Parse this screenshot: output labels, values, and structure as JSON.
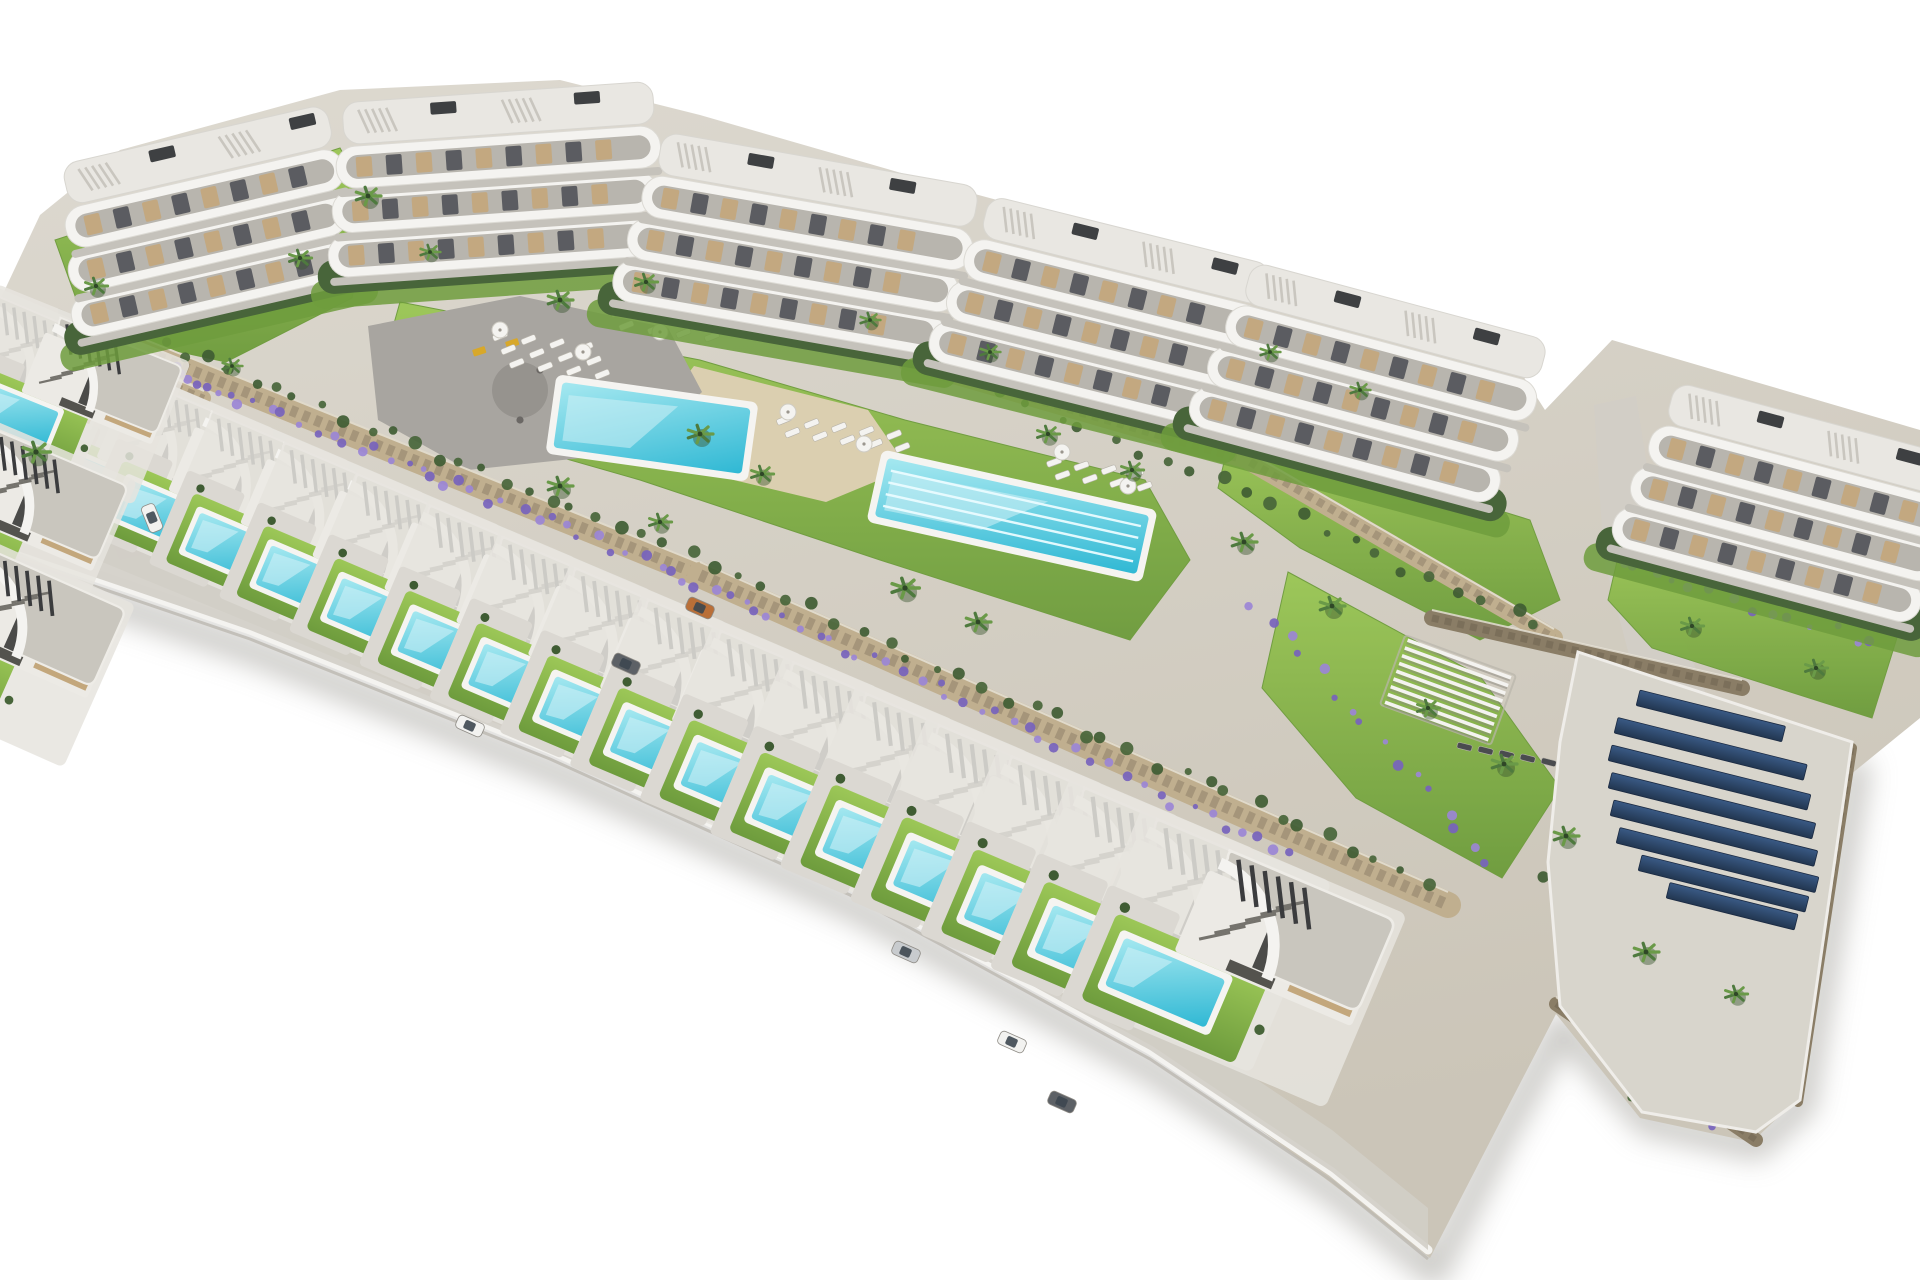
{
  "scene": {
    "description": "Aerial 3D architectural render of a hillside residential development on a white background: a curved row of six white apartment blocks with wavy terraces at the top, communal gardens with a main swimming pool, a lap pool, sun loungers, a playground plaza and palm trees in the middle, a long diagonal row of modern villas each with a private turquoise pool in front, and a rooftop solar-panel array at the lower right."
  },
  "palette": {
    "bg": "#ffffff",
    "terrain_light": "#ddd9d0",
    "terrain_dark": "#cbc5b8",
    "road": "#d2cec6",
    "drive": "#dbd8d2",
    "plot": "#e6e4de",
    "white1": "#f4f3f0",
    "white2": "#eceae5",
    "roof": "#c9c6be",
    "roof_edge": "#eeece7",
    "slat": "#3b3c3e",
    "stair": "#75736d",
    "beige": "#c3a77c",
    "win": "#4b4b49",
    "door": "#54534e",
    "lawn_light": "#9cc757",
    "lawn_dark": "#6e9c3d",
    "hedge": "#48653a",
    "scrub": "#3f5c33",
    "palm1": "#4e7a3e",
    "palm2": "#6a9a48",
    "lavender1": "#9b85d6",
    "lavender2": "#7763bd",
    "pool_rim": "#f5f4f1",
    "pool_light": "#a5e8f0",
    "pool_dark": "#2fb8d4",
    "sand": "#dbcfb0",
    "plaza": "#a8a5a0",
    "plaza_dark": "#96938e",
    "wall_tan": "#c0af8f",
    "wall_joint": "#8f8069",
    "wall_dark": "#8a7d66",
    "wall_dark2": "#6f6452",
    "deck": "#d8d5cc",
    "solar_light": "#3a5a85",
    "solar_dark": "#223650",
    "shadow": "#c6c5c1",
    "terrace": "#b8b5ae",
    "furn": "#53555a",
    "car_white": "#f2f2f0",
    "car_orange": "#b96f38",
    "car_gray": "#5d6166",
    "car_silver": "#c8cbce",
    "play_yellow": "#d8a82a"
  },
  "site": {
    "outline": [
      [
        40,
        215
      ],
      [
        120,
        150
      ],
      [
        340,
        90
      ],
      [
        560,
        80
      ],
      [
        700,
        115
      ],
      [
        960,
        190
      ],
      [
        1250,
        268
      ],
      [
        1500,
        340
      ],
      [
        1545,
        410
      ],
      [
        1612,
        340
      ],
      [
        1920,
        430
      ],
      [
        1920,
        718
      ],
      [
        1850,
        775
      ],
      [
        1788,
        1108
      ],
      [
        1752,
        1142
      ],
      [
        1640,
        1118
      ],
      [
        1556,
        1014
      ],
      [
        1497,
        1128
      ],
      [
        1430,
        1258
      ],
      [
        1150,
        1046
      ],
      [
        848,
        880
      ],
      [
        548,
        745
      ],
      [
        248,
        622
      ],
      [
        0,
        520
      ],
      [
        0,
        300
      ]
    ],
    "curb": [
      [
        0,
        545
      ],
      [
        250,
        630
      ],
      [
        550,
        750
      ],
      [
        850,
        886
      ],
      [
        1150,
        1050
      ],
      [
        1332,
        1172
      ],
      [
        1428,
        1250
      ]
    ],
    "shadow_extra": [
      [
        1500,
        1138
      ],
      [
        1562,
        1026
      ],
      [
        1648,
        1122
      ],
      [
        1756,
        1146
      ],
      [
        1802,
        1104
      ],
      [
        1856,
        772
      ]
    ],
    "roads": [
      [
        [
          1594,
          405
        ],
        [
          1636,
          396
        ],
        [
          1668,
          600
        ],
        [
          1706,
          694
        ],
        [
          1644,
          712
        ],
        [
          1604,
          560
        ]
      ],
      [
        [
          58,
          308
        ],
        [
          108,
          330
        ],
        [
          170,
          548
        ],
        [
          120,
          560
        ],
        [
          60,
          430
        ]
      ]
    ]
  },
  "lawns": [
    [
      [
        55,
        240
      ],
      [
        340,
        148
      ],
      [
        372,
        205
      ],
      [
        352,
        298
      ],
      [
        226,
        362
      ],
      [
        88,
        332
      ]
    ],
    [
      [
        400,
        302
      ],
      [
        700,
        360
      ],
      [
        905,
        420
      ],
      [
        1145,
        480
      ],
      [
        1190,
        560
      ],
      [
        1130,
        640
      ],
      [
        880,
        560
      ],
      [
        640,
        480
      ],
      [
        430,
        420
      ],
      [
        386,
        352
      ]
    ],
    [
      [
        1288,
        572
      ],
      [
        1480,
        676
      ],
      [
        1560,
        788
      ],
      [
        1502,
        878
      ],
      [
        1356,
        798
      ],
      [
        1262,
        688
      ]
    ],
    [
      [
        1622,
        540
      ],
      [
        1900,
        628
      ],
      [
        1872,
        718
      ],
      [
        1652,
        648
      ],
      [
        1608,
        600
      ]
    ],
    [
      [
        1232,
        428
      ],
      [
        1530,
        520
      ],
      [
        1560,
        600
      ],
      [
        1480,
        640
      ],
      [
        1300,
        548
      ],
      [
        1218,
        488
      ]
    ]
  ],
  "sand": [
    [
      694,
      366
    ],
    [
      868,
      410
    ],
    [
      908,
      468
    ],
    [
      826,
      502
    ],
    [
      700,
      472
    ],
    [
      652,
      420
    ]
  ],
  "playground": {
    "outline": [
      [
        368,
        326
      ],
      [
        520,
        296
      ],
      [
        668,
        328
      ],
      [
        702,
        392
      ],
      [
        638,
        452
      ],
      [
        468,
        470
      ],
      [
        378,
        420
      ]
    ],
    "inner": {
      "cx": 520,
      "cy": 390,
      "r": 28
    },
    "equipment": [
      [
        472,
        350
      ],
      [
        505,
        342
      ]
    ],
    "dots": [
      [
        540,
        370
      ],
      [
        575,
        385
      ],
      [
        520,
        420
      ],
      [
        620,
        398
      ]
    ]
  },
  "walls": [
    {
      "x1": 146,
      "y1": 352,
      "x2": 700,
      "y2": 575,
      "w": 24,
      "tone": "tan"
    },
    {
      "x1": 700,
      "y1": 575,
      "x2": 1448,
      "y2": 905,
      "w": 26,
      "tone": "tan"
    },
    {
      "x1": 44,
      "y1": 330,
      "x2": 204,
      "y2": 398,
      "w": 14,
      "tone": "tan"
    },
    {
      "x1": 905,
      "y1": 362,
      "x2": 1250,
      "y2": 462,
      "w": 16,
      "tone": "tan"
    },
    {
      "x1": 1250,
      "y1": 462,
      "x2": 1554,
      "y2": 638,
      "w": 18,
      "tone": "tan"
    },
    {
      "x1": 1432,
      "y1": 618,
      "x2": 1742,
      "y2": 688,
      "w": 16,
      "tone": "dark"
    },
    {
      "x1": 1556,
      "y1": 1004,
      "x2": 1756,
      "y2": 1140,
      "w": 14,
      "tone": "dark"
    },
    {
      "x1": 1852,
      "y1": 748,
      "x2": 1798,
      "y2": 1102,
      "w": 10,
      "tone": "dark"
    }
  ],
  "planting": {
    "lavender": [
      {
        "x1": 150,
        "y1": 360,
        "x2": 440,
        "y2": 478,
        "n": 20
      },
      {
        "x1": 440,
        "y1": 478,
        "x2": 708,
        "y2": 585,
        "n": 18
      },
      {
        "x1": 708,
        "y1": 585,
        "x2": 1000,
        "y2": 718,
        "n": 20
      },
      {
        "x1": 1000,
        "y1": 718,
        "x2": 1300,
        "y2": 860,
        "n": 18
      },
      {
        "x1": 1248,
        "y1": 600,
        "x2": 1500,
        "y2": 868,
        "n": 16
      },
      {
        "x1": 1608,
        "y1": 556,
        "x2": 1880,
        "y2": 648,
        "n": 14
      },
      {
        "x1": 1560,
        "y1": 1010,
        "x2": 1726,
        "y2": 1128,
        "n": 10
      },
      {
        "x1": 60,
        "y1": 318,
        "x2": 206,
        "y2": 390,
        "n": 10
      }
    ],
    "bushes": [
      {
        "x1": 150,
        "y1": 340,
        "x2": 700,
        "y2": 560,
        "n": 24
      },
      {
        "x1": 700,
        "y1": 560,
        "x2": 1440,
        "y2": 890,
        "n": 30
      },
      {
        "x1": 910,
        "y1": 350,
        "x2": 1554,
        "y2": 630,
        "n": 24
      },
      {
        "x1": 1545,
        "y1": 860,
        "x2": 1640,
        "y2": 1110,
        "n": 10
      }
    ],
    "palms": [
      [
        368,
        196,
        1.0
      ],
      [
        300,
        258,
        0.9
      ],
      [
        96,
        286,
        0.9
      ],
      [
        36,
        452,
        1.1
      ],
      [
        232,
        366,
        0.8
      ],
      [
        430,
        252,
        0.8
      ],
      [
        560,
        300,
        1.0
      ],
      [
        646,
        282,
        0.9
      ],
      [
        700,
        434,
        1.0
      ],
      [
        762,
        474,
        0.9
      ],
      [
        560,
        486,
        1.0
      ],
      [
        660,
        522,
        0.9
      ],
      [
        905,
        588,
        1.1
      ],
      [
        978,
        622,
        1.0
      ],
      [
        1048,
        434,
        0.9
      ],
      [
        1132,
        470,
        0.9
      ],
      [
        1244,
        542,
        1.0
      ],
      [
        1332,
        606,
        1.0
      ],
      [
        1428,
        708,
        0.9
      ],
      [
        1504,
        764,
        1.0
      ],
      [
        1566,
        836,
        1.0
      ],
      [
        1692,
        626,
        0.9
      ],
      [
        1816,
        668,
        0.9
      ],
      [
        1646,
        952,
        1.0
      ],
      [
        1736,
        994,
        0.9
      ],
      [
        1270,
        352,
        0.8
      ],
      [
        1360,
        390,
        0.8
      ],
      [
        870,
        320,
        0.8
      ],
      [
        990,
        352,
        0.8
      ]
    ]
  },
  "pools": {
    "main": {
      "cx": 652,
      "cy": 428,
      "w": 190,
      "h": 66,
      "rot": 8
    },
    "lap": {
      "cx": 1012,
      "cy": 516,
      "w": 268,
      "h": 60,
      "rot": 12.5,
      "lanes": 4
    }
  },
  "loungers": [
    {
      "x": 492,
      "y": 336,
      "rows": 3,
      "cols": 4,
      "dx": 27,
      "dy": 17,
      "rot": -22,
      "tone": "light"
    },
    {
      "x": 610,
      "y": 312,
      "rows": 2,
      "cols": 4,
      "dx": 27,
      "dy": 17,
      "rot": -22,
      "tone": "light"
    },
    {
      "x": 776,
      "y": 420,
      "rows": 2,
      "cols": 5,
      "dx": 26,
      "dy": 16,
      "rot": -22,
      "tone": "light"
    },
    {
      "x": 1046,
      "y": 462,
      "rows": 2,
      "cols": 4,
      "dx": 26,
      "dy": 16,
      "rot": -20,
      "tone": "light"
    },
    {
      "x": 1458,
      "y": 742,
      "rows": 1,
      "cols": 5,
      "dx": 22,
      "dy": 0,
      "rot": 14,
      "tone": "dark"
    }
  ],
  "parasols": [
    [
      500,
      330
    ],
    [
      583,
      352
    ],
    [
      660,
      332
    ],
    [
      788,
      412
    ],
    [
      864,
      444
    ],
    [
      1062,
      452
    ],
    [
      1128,
      486
    ]
  ],
  "pergola": {
    "cx": 1448,
    "cy": 690,
    "w": 110,
    "h": 66,
    "rot": 20,
    "slats": 9
  },
  "solar": {
    "deck": [
      [
        1578,
        652
      ],
      [
        1852,
        742
      ],
      [
        1800,
        1100
      ],
      [
        1756,
        1132
      ],
      [
        1642,
        1112
      ],
      [
        1560,
        1006
      ],
      [
        1548,
        862
      ],
      [
        1560,
        742
      ]
    ],
    "start": [
      1612,
      690
    ],
    "dy": 27.5,
    "rot": 14,
    "bar_h": 16,
    "lengths": [
      150,
      195,
      205,
      210,
      210,
      205,
      172,
      132
    ],
    "xoff": [
      28,
      6,
      0,
      0,
      2,
      8,
      30,
      58
    ]
  },
  "buildings": [
    {
      "cx": 200,
      "cy": 240,
      "w": 285,
      "h": 175,
      "rot": -13
    },
    {
      "cx": 487,
      "cy": 195,
      "w": 325,
      "h": 180,
      "rot": -4
    },
    {
      "cx": 788,
      "cy": 252,
      "w": 335,
      "h": 190,
      "rot": 10
    },
    {
      "cx": 1092,
      "cy": 318,
      "w": 305,
      "h": 195,
      "rot": 14
    },
    {
      "cx": 1360,
      "cy": 388,
      "w": 320,
      "h": 195,
      "rot": 15
    },
    {
      "cx": 1782,
      "cy": 508,
      "w": 318,
      "h": 195,
      "rot": 15
    }
  ],
  "villas": {
    "count": 16,
    "start": [
      78,
      352
    ],
    "step": [
      71.5,
      30.8
    ],
    "rot": 23,
    "scale_start": 1.0,
    "scale_step": 0.02,
    "extra": [
      {
        "x": -64,
        "y": 268,
        "rot": 23,
        "s": 1.0
      },
      {
        "x": 2,
        "y": 292,
        "rot": 22,
        "s": 0.95
      },
      {
        "x": -70,
        "y": 400,
        "rot": 23,
        "s": 1.05
      },
      {
        "x": -80,
        "y": 516,
        "rot": 24,
        "s": 1.1
      }
    ]
  },
  "cars": [
    {
      "x": 152,
      "y": 518,
      "rot": 68,
      "tone": "white"
    },
    {
      "x": 470,
      "y": 726,
      "rot": 24,
      "tone": "white"
    },
    {
      "x": 700,
      "y": 608,
      "rot": 24,
      "tone": "orange"
    },
    {
      "x": 626,
      "y": 664,
      "rot": 24,
      "tone": "gray"
    },
    {
      "x": 906,
      "y": 952,
      "rot": 24,
      "tone": "silver"
    },
    {
      "x": 1012,
      "y": 1042,
      "rot": 24,
      "tone": "white"
    },
    {
      "x": 1062,
      "y": 1102,
      "rot": 24,
      "tone": "gray"
    }
  ]
}
